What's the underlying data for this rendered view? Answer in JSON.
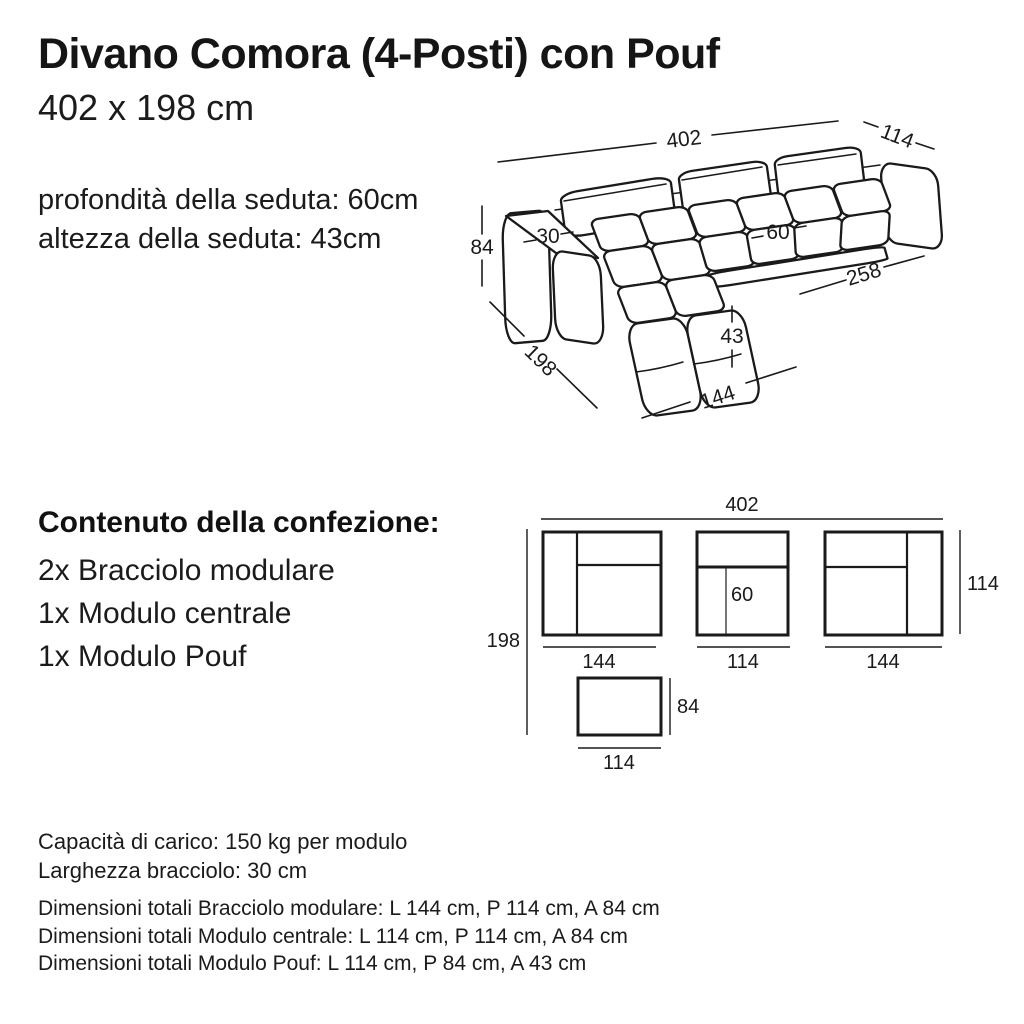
{
  "header": {
    "title": "Divano Comora (4-Posti) con Pouf",
    "subtitle": "402 x 198 cm",
    "seat_depth": "profondità della seduta: 60cm",
    "seat_height": "altezza della seduta: 43cm"
  },
  "perspective_diagram": {
    "total_width": "402",
    "total_depth": "114",
    "total_height": "84",
    "armrest_width": "30",
    "seat_depth": "60",
    "right_section_length": "258",
    "side_depth": "198",
    "pouf_height": "43",
    "front_width": "144"
  },
  "package_contents": {
    "heading": "Contenuto della confezione:",
    "items": [
      "2x Bracciolo modulare",
      "1x Modulo centrale",
      "1x Modulo Pouf"
    ]
  },
  "top_view_diagram": {
    "total_width": "402",
    "total_depth": "198",
    "left_module_width": "144",
    "center_module_width": "114",
    "right_module_width": "144",
    "module_depth": "114",
    "seat_depth": "60",
    "pouf_depth": "84",
    "pouf_width": "114"
  },
  "specs": {
    "load_capacity": "Capacità di carico: 150 kg per modulo",
    "armrest_width": "Larghezza bracciolo: 30 cm",
    "dimension_notes": [
      "Dimensioni totali Bracciolo modulare: L 144 cm, P 114 cm, A 84 cm",
      "Dimensioni totali Modulo centrale: L 114 cm, P 114 cm, A 84 cm",
      "Dimensioni totali Modulo Pouf: L 114 cm, P 84 cm, A 43 cm"
    ]
  }
}
